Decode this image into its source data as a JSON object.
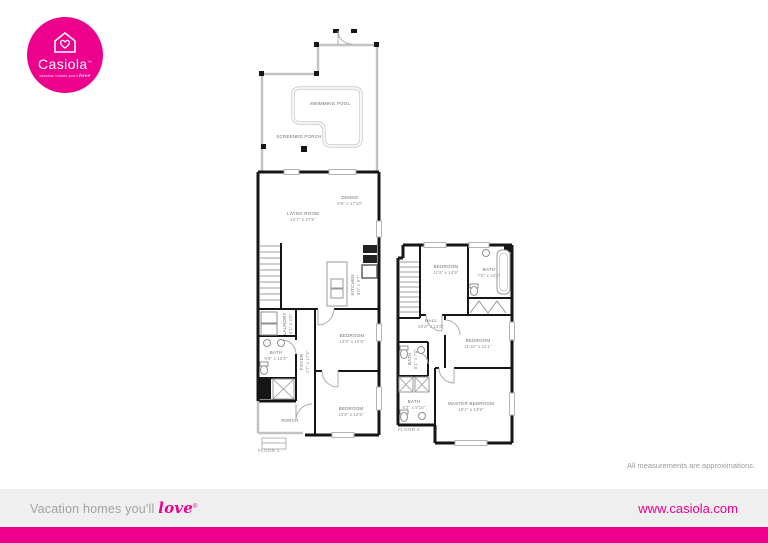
{
  "brand": {
    "name": "Casiola",
    "trademark": "™",
    "tagline_prefix": "vacation homes you'll",
    "tagline_script": "love"
  },
  "footer": {
    "tagline_prefix": "Vacation homes you'll",
    "tagline_script": "love",
    "trademark": "®",
    "website": "www.casiola.com"
  },
  "disclaimer": "All measurements are approximations.",
  "colors": {
    "brand_pink": "#ec008c",
    "wall_black": "#161616",
    "wall_gray": "#c2c2c2",
    "label_gray": "#6f6f6f"
  },
  "floor1": {
    "label": "FLOOR 1",
    "rooms": {
      "swimming_pool": {
        "name": "SWIMMING POOL",
        "dims": ""
      },
      "screened_porch": {
        "name": "SCREENED PORCH",
        "dims": ""
      },
      "dining": {
        "name": "DINING",
        "dims": "9'6\" x 17'10\""
      },
      "living_room": {
        "name": "LIVING ROOM",
        "dims": "13'7\" x 27'5\""
      },
      "kitchen": {
        "name": "KITCHEN",
        "dims": "9'6\" x 9'7\""
      },
      "laundry": {
        "name": "LAUNDRY",
        "dims": "5'1\" x 4'0\""
      },
      "bath": {
        "name": "BATH",
        "dims": "5'6\" x 12'0\""
      },
      "foyer": {
        "name": "FOYER",
        "dims": "4'7\" x 17'9\""
      },
      "bedroom_front": {
        "name": "BEDROOM",
        "dims": "13'9\" x 12'5\""
      },
      "bedroom_back": {
        "name": "BEDROOM",
        "dims": "13'9\" x 12'6\""
      },
      "porch": {
        "name": "PORCH",
        "dims": ""
      }
    }
  },
  "floor2": {
    "label": "FLOOR 2",
    "rooms": {
      "bedroom_left": {
        "name": "BEDROOM",
        "dims": "11'9\" x 14'9\""
      },
      "bath_top": {
        "name": "BATH",
        "dims": "7'0\" x 14'5\""
      },
      "hall": {
        "name": "HALL",
        "dims": "20'8\" x 12'0\""
      },
      "bedroom_right": {
        "name": "BEDROOM",
        "dims": "11'10\" x 11'1\""
      },
      "bath_small": {
        "name": "BATH",
        "dims": "8'1\" x 7'0\""
      },
      "bath_lower": {
        "name": "BATH",
        "dims": "6'2\" x 9'10\""
      },
      "master_bedroom": {
        "name": "MASTER BEDROOM",
        "dims": "16'1\" x 13'9\""
      }
    }
  }
}
